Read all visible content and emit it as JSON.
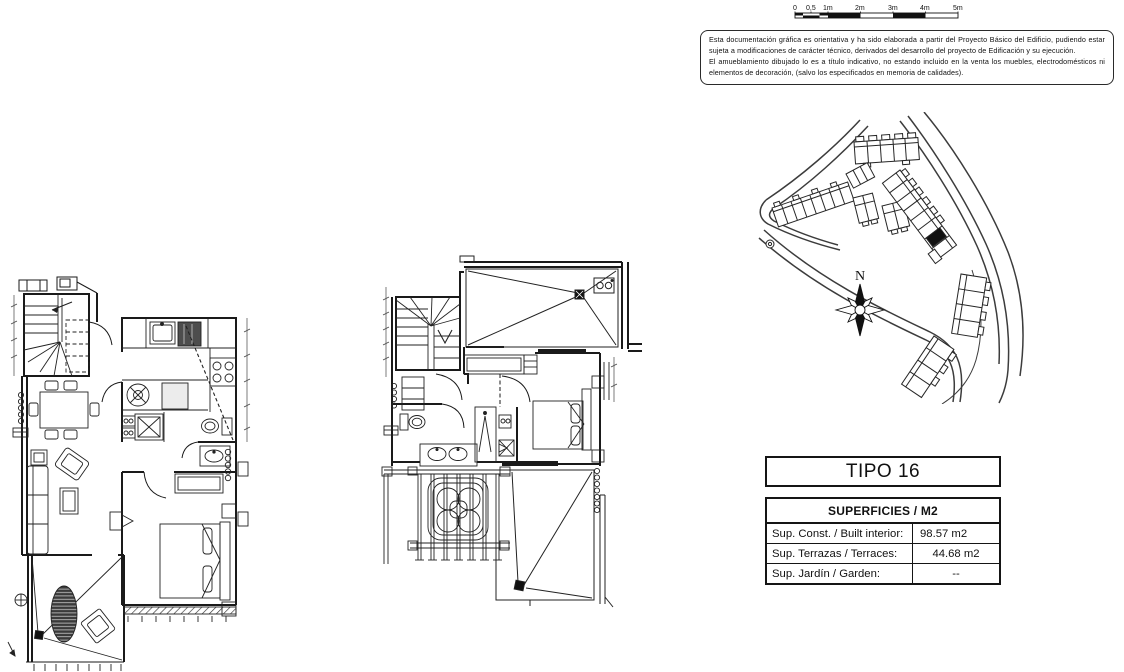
{
  "scale_bar": {
    "labels": [
      "0",
      "0,5",
      "1m",
      "2m",
      "3m",
      "4m",
      "5m"
    ]
  },
  "disclaimer": {
    "paragraph1": "Esta documentación gráfica es orientativa y ha sido elaborada a partir del Proyecto Básico del Edificio, pudiendo estar sujeta a modificaciones de carácter técnico, derivados del desarrollo del proyecto de Edificación y su ejecución.",
    "paragraph2": "El amueblamiento dibujado lo es a título indicativo, no estando incluido en la venta los muebles, electrodomésticos ni elementos de decoración, (salvo los especificados en memoria de calidades)."
  },
  "site_plan": {
    "north_label": "N"
  },
  "title_box": {
    "label": "TIPO 16"
  },
  "surfaces_table": {
    "header": "SUPERFICIES / M2",
    "rows": [
      {
        "label": "Sup. Const. / Built interior:",
        "value": "98.57 m2"
      },
      {
        "label": "Sup. Terrazas / Terraces:",
        "value": "44.68 m2"
      },
      {
        "label": "Sup. Jardín / Garden:",
        "value": "--"
      }
    ]
  },
  "colors": {
    "line": "#222222",
    "wall": "#1a1a1a",
    "highlight_fill": "#111111",
    "background": "#ffffff"
  }
}
